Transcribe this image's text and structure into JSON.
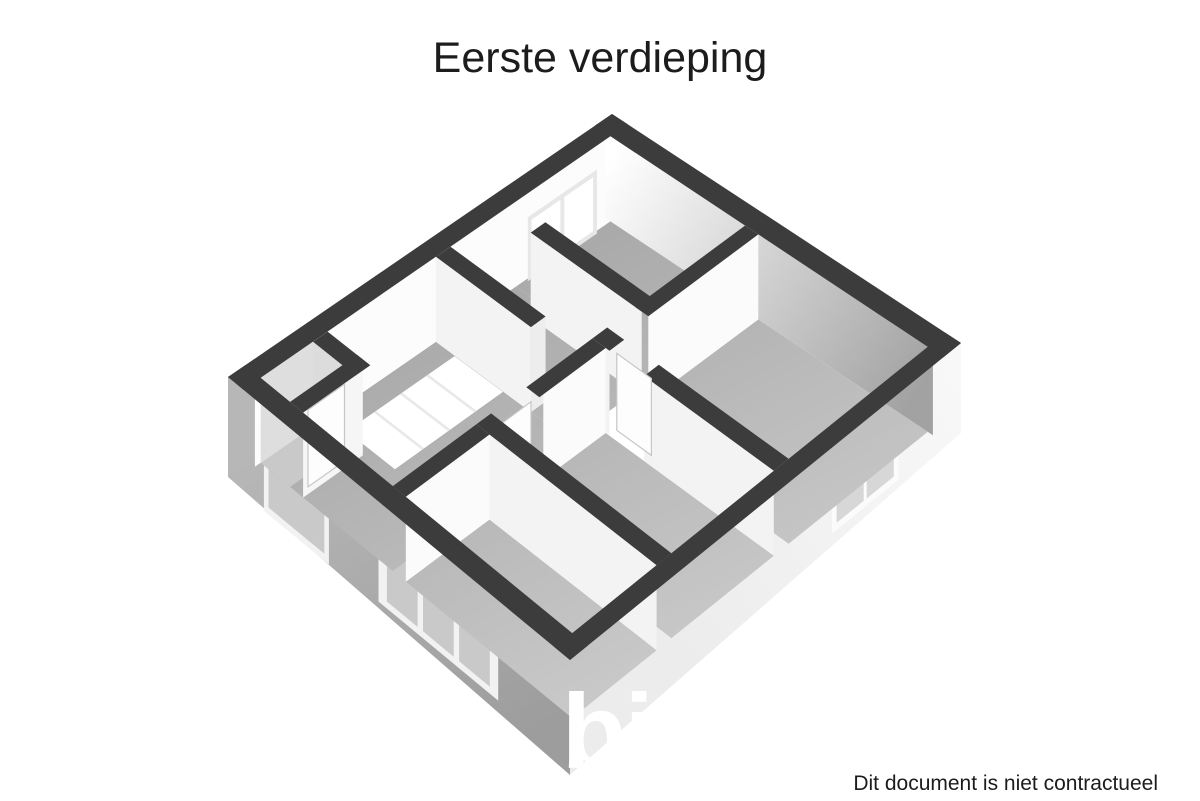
{
  "page": {
    "title": "Eerste verdieping",
    "watermark": "biddit",
    "disclaimer": "Dit document is niet contractueel",
    "background": "#ffffff"
  },
  "palette": {
    "wall_cap": "#3c3c3c",
    "floor_dark": "#a4a4a4",
    "floor_light": "#c9c9c9",
    "face_white": "#fbfbfb",
    "face_light": "#f3f3f3",
    "ne_face_dark": "#a2a2a2",
    "skirt_sw_top": "#b7b7b7",
    "skirt_sw_bottom": "#9d9d9d",
    "skirt_se_top": "#f8f8f8",
    "skirt_se_bottom": "#ececec",
    "glass_sw": "#c9c9c9",
    "glass_se": "#d7d7d7",
    "frame_white": "#f2f2f2",
    "stairwell_white": "#ffffff",
    "text": "#1c1c1c",
    "watermark_white": "#ffffff"
  },
  "floor_plan": {
    "projection": "3d-axonometric-top-view",
    "rooms_visible": 7,
    "windows": [
      "back-left-double",
      "left-single",
      "front-left-triple",
      "front-right-double"
    ],
    "doors_visible": 3,
    "stairwell": true
  }
}
